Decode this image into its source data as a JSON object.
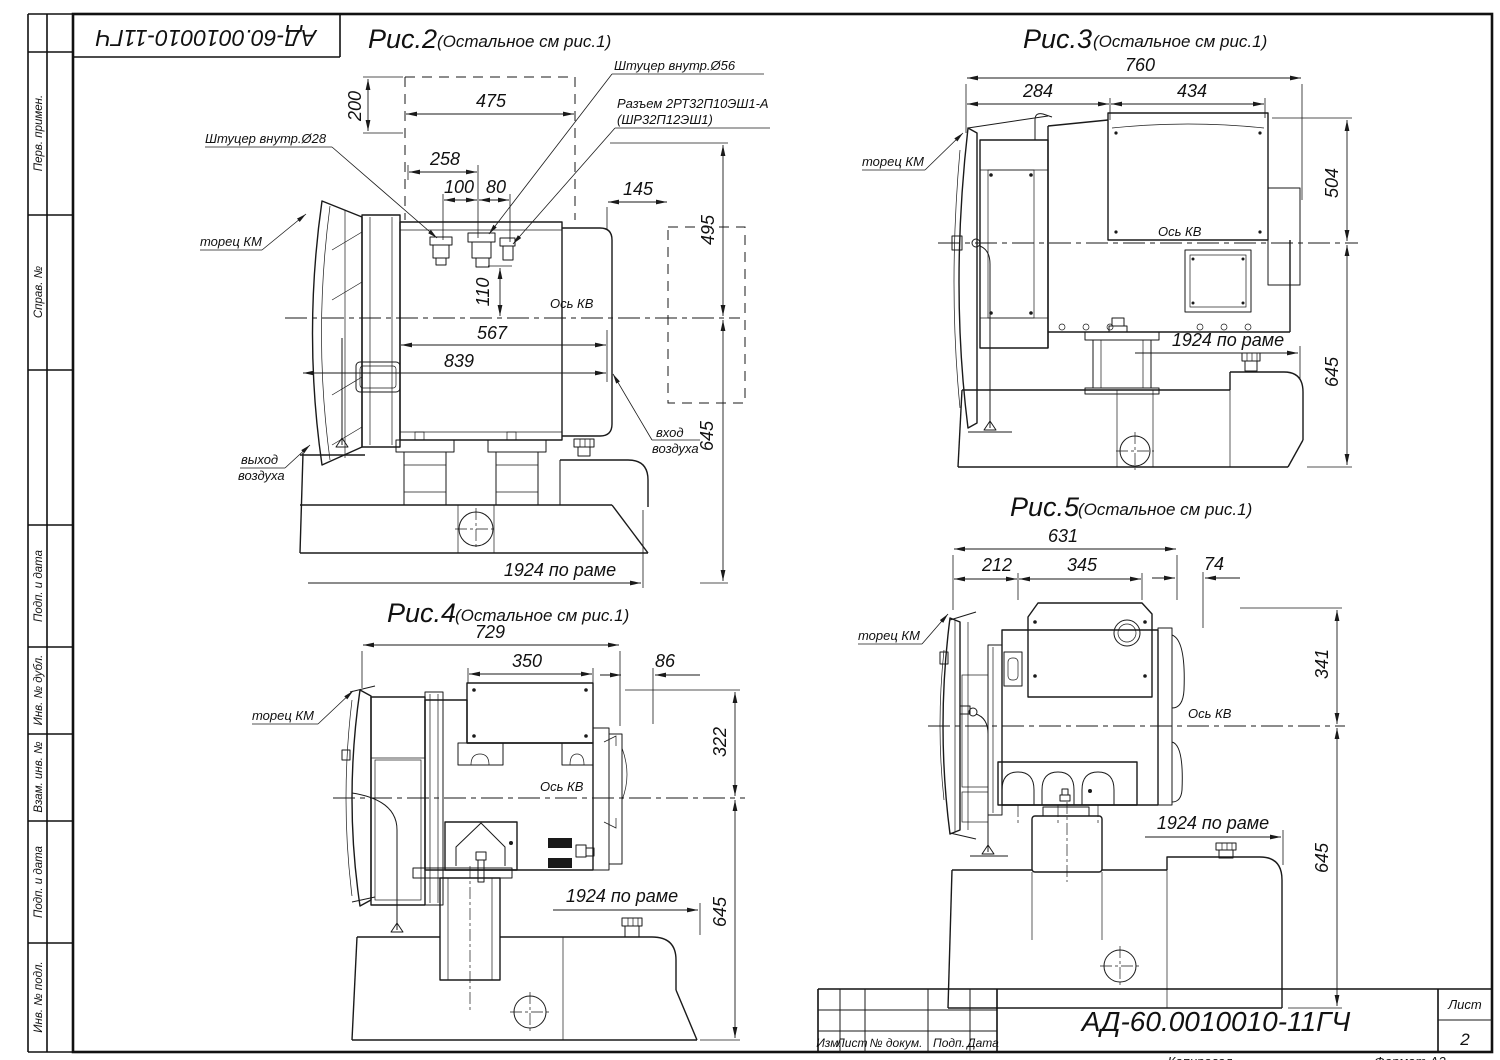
{
  "page": {
    "bg": "#ffffff",
    "line_color": "#1a1a1a"
  },
  "stamp": {
    "doc_number": "АД-60.0010010-11ГЧ"
  },
  "margin_labels": [
    "Перв. примен.",
    "Справ. №",
    "Подп. и дата",
    "Инв. № дубл.",
    "Взам. инв. №",
    "Подп. и дата",
    "Инв. № подл."
  ],
  "figures": {
    "fig2": {
      "title": "Рис.2",
      "subtitle": "(Остальное см рис.1)",
      "axis_label": "Ось КВ",
      "dims": {
        "w475": "475",
        "w258": "258",
        "w100": "100",
        "w80": "80",
        "w145": "145",
        "h200": "200",
        "h495": "495",
        "h110": "110",
        "l567": "567",
        "l839": "839",
        "h645": "645",
        "frame": "1924 по раме"
      },
      "labels": {
        "fitting28": "Штуцер внутр.Ø28",
        "fitting56": "Штуцер внутр.Ø56",
        "connector_line1": "Разъем 2РТ32П10ЭШ1-А",
        "connector_line2": "(ШР32П12ЭШ1)",
        "km_face": "торец КМ",
        "air_out_line1": "выход",
        "air_out_line2": "воздуха",
        "air_in_line1": "вход",
        "air_in_line2": "воздуха"
      }
    },
    "fig3": {
      "title": "Рис.3",
      "subtitle": "(Остальное см рис.1)",
      "axis_label": "Ось КВ",
      "dims": {
        "w760": "760",
        "w284": "284",
        "w434": "434",
        "h504": "504",
        "h645": "645",
        "frame": "1924 по раме"
      },
      "labels": {
        "km_face": "торец КМ"
      }
    },
    "fig4": {
      "title": "Рис.4",
      "subtitle": "(Остальное см рис.1)",
      "axis_label": "Ось КВ",
      "dims": {
        "w729": "729",
        "w350": "350",
        "w86": "86",
        "h322": "322",
        "h645": "645",
        "frame": "1924 по раме"
      },
      "labels": {
        "km_face": "торец КМ"
      }
    },
    "fig5": {
      "title": "Рис.5",
      "subtitle": "(Остальное см рис.1)",
      "axis_label": "Ось КВ",
      "dims": {
        "w631": "631",
        "w212": "212",
        "w345": "345",
        "w74": "74",
        "h341": "341",
        "h645": "645",
        "frame": "1924 по раме"
      },
      "labels": {
        "km_face": "торец КМ"
      }
    }
  },
  "title_block": {
    "columns": [
      "Изм.",
      "Лист",
      "№ докум.",
      "Подп.",
      "Дата"
    ],
    "doc_number": "АД-60.0010010-11ГЧ",
    "sheet_label": "Лист",
    "sheet_number": "2"
  },
  "footer": {
    "copied_label": "Копировал",
    "format_label": "Формат А3"
  }
}
